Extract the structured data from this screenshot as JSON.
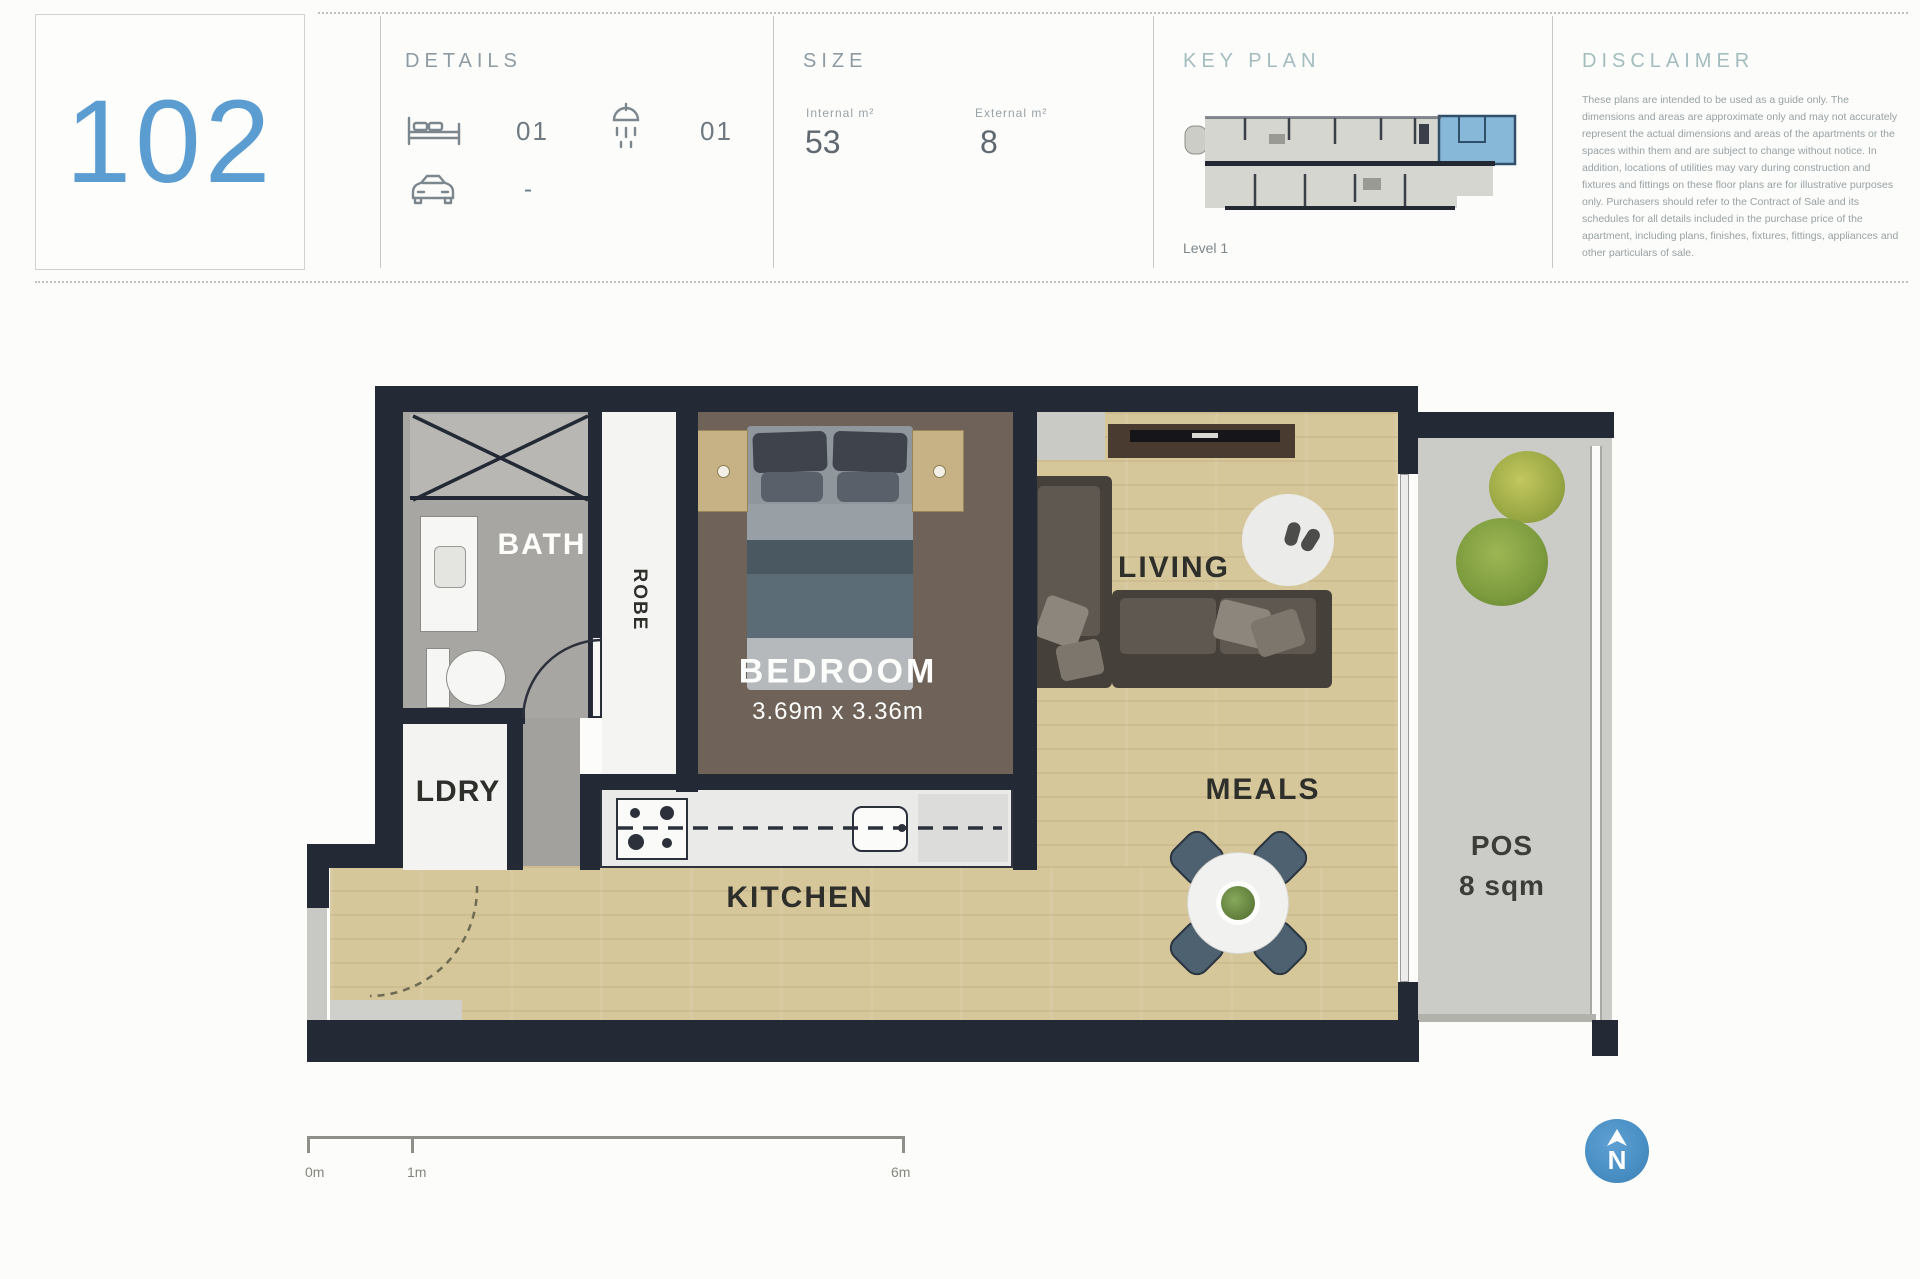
{
  "header": {
    "unit_number": "102",
    "details": {
      "title": "DETAILS",
      "bedrooms_value": "01",
      "bathrooms_value": "01",
      "parking_value": "-"
    },
    "size": {
      "title": "SIZE",
      "internal_label": "Internal m²",
      "internal_value": "53",
      "external_label": "External m²",
      "external_value": "8"
    },
    "key_plan": {
      "title": "KEY PLAN",
      "level": "Level 1"
    },
    "disclaimer": {
      "title": "DISCLAIMER",
      "body": "These plans are intended to be used as a guide only. The dimensions and areas are approximate only and may not accurately represent the actual dimensions and areas of the apartments or the spaces within them and are subject to change without notice. In addition, locations of utilities may vary during construction and fixtures and fittings on these floor plans are for illustrative purposes only. Purchasers should refer to the Contract of Sale and its schedules for all details included in the purchase price of the apartment, including plans, finishes, fixtures, fittings, appliances and other particulars of sale."
    }
  },
  "floor_plan": {
    "rooms": {
      "bath": "BATH",
      "laundry": "LDRY",
      "robe": "ROBE",
      "bedroom_label": "BEDROOM",
      "bedroom_dimensions": "3.69m x 3.36m",
      "kitchen": "KITCHEN",
      "living": "LIVING",
      "meals": "MEALS",
      "pos_label": "POS",
      "pos_area": "8 sqm"
    }
  },
  "scale_bar": {
    "tick_0": "0m",
    "tick_1": "1m",
    "tick_6": "6m"
  },
  "compass": {
    "north": "N"
  },
  "colors": {
    "accent_blue": "#5b9dd1",
    "title_gray": "#8e9ba3",
    "title_teal": "#a3bdbe",
    "wall": "#242936",
    "wood_floor": "#d6c79b",
    "carpet": "#6e6259",
    "balcony": "#cbcbc7",
    "key_plan_highlight": "#88b8d8",
    "compass_blue": "#4a90c5"
  }
}
